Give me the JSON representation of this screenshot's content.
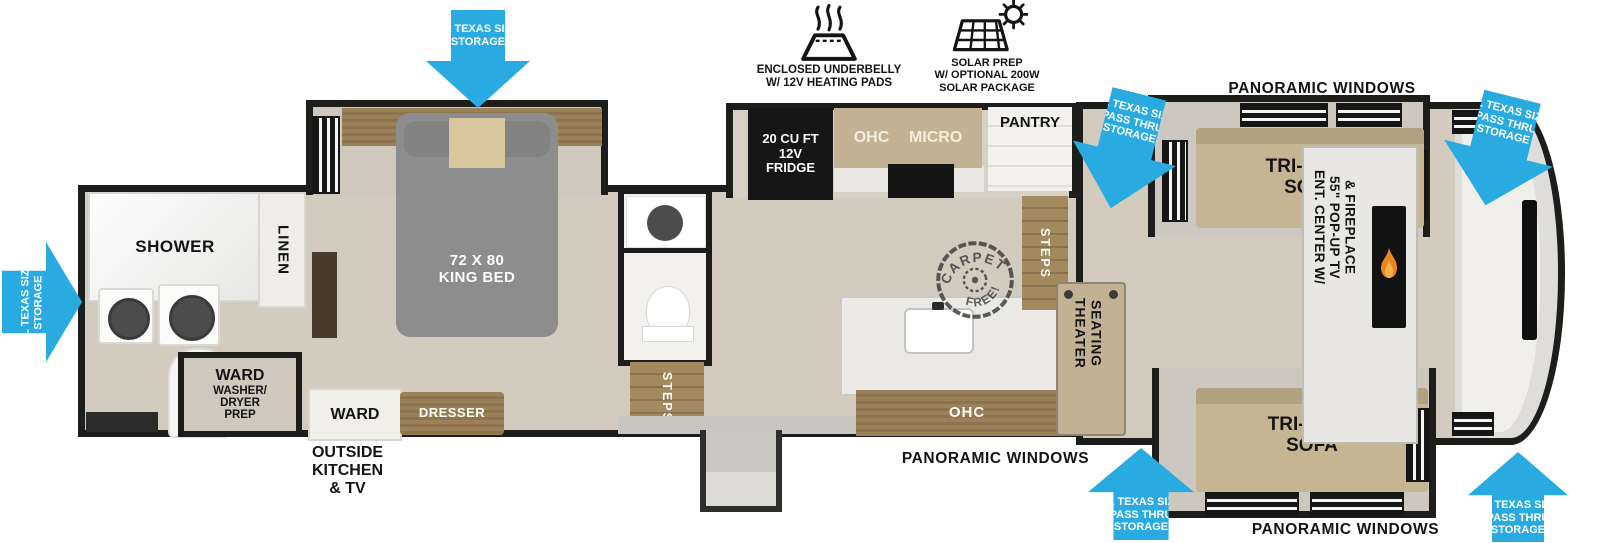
{
  "colors": {
    "arrow_blue": "#29abe2",
    "wall": "#1d1d1b",
    "floor": "#d2cbbe",
    "furniture_tan": "#c6b593",
    "cabinet_wood": "#99815a",
    "bed_gray": "#8d8d8d",
    "flame_orange": "#e8871e"
  },
  "callouts": {
    "underbelly": "ENCLOSED UNDERBELLY\nW/ 12V HEATING PADS",
    "solar": "SOLAR PREP\nW/ OPTIONAL 200W\nSOLAR PACKAGE"
  },
  "arrows": {
    "bedroom_storage": "XL TEXAS SIZE\nSTORAGE",
    "rear_storage": "XL TEXAS SIZE\nSTORAGE",
    "pass_thru_top_left": "XL TEXAS SIZE\nPASS THRU\nSTORAGE",
    "pass_thru_top_right": "XL TEXAS SIZE\nPASS THRU\nSTORAGE",
    "pass_thru_bottom_left": "XL TEXAS SIZE\nPASS THRU\nSTORAGE",
    "pass_thru_bottom_right": "XL TEXAS SIZE\nPASS THRU\nSTORAGE"
  },
  "exterior": {
    "panoramic_top": "PANORAMIC WINDOWS",
    "panoramic_bottom": "PANORAMIC WINDOWS",
    "panoramic_front": "PANORAMIC WINDOWS",
    "outside_kitchen": "OUTSIDE\nKITCHEN\n& TV"
  },
  "rear_bath": {
    "shower": "SHOWER",
    "linen": "LINEN",
    "ward": "WARD",
    "washer_prep": "WASHER/\nDRYER\nPREP"
  },
  "bedroom": {
    "bed": "72 X 80\nKING BED",
    "dresser": "DRESSER",
    "ward": "WARD"
  },
  "mid_bath": {
    "steps": "STEPS"
  },
  "kitchen": {
    "fridge": "20 CU FT\n12V\nFRIDGE",
    "ohc": "OHC",
    "micro": "MICRO",
    "pantry": "PANTRY",
    "island_ohc": "OHC",
    "steps": "STEPS"
  },
  "living": {
    "theater": "THEATER\nSEATING",
    "sofa_top": "TRI-FOLD\nSOFA",
    "sofa_bottom": "TRI-FOLD\nSOFA",
    "ent_center": "ENT. CENTER W/\n55\" POP-UP TV\n& FIREPLACE"
  },
  "stamp": {
    "arc_top": "CARPET",
    "arc_bottom": "FREE!"
  }
}
